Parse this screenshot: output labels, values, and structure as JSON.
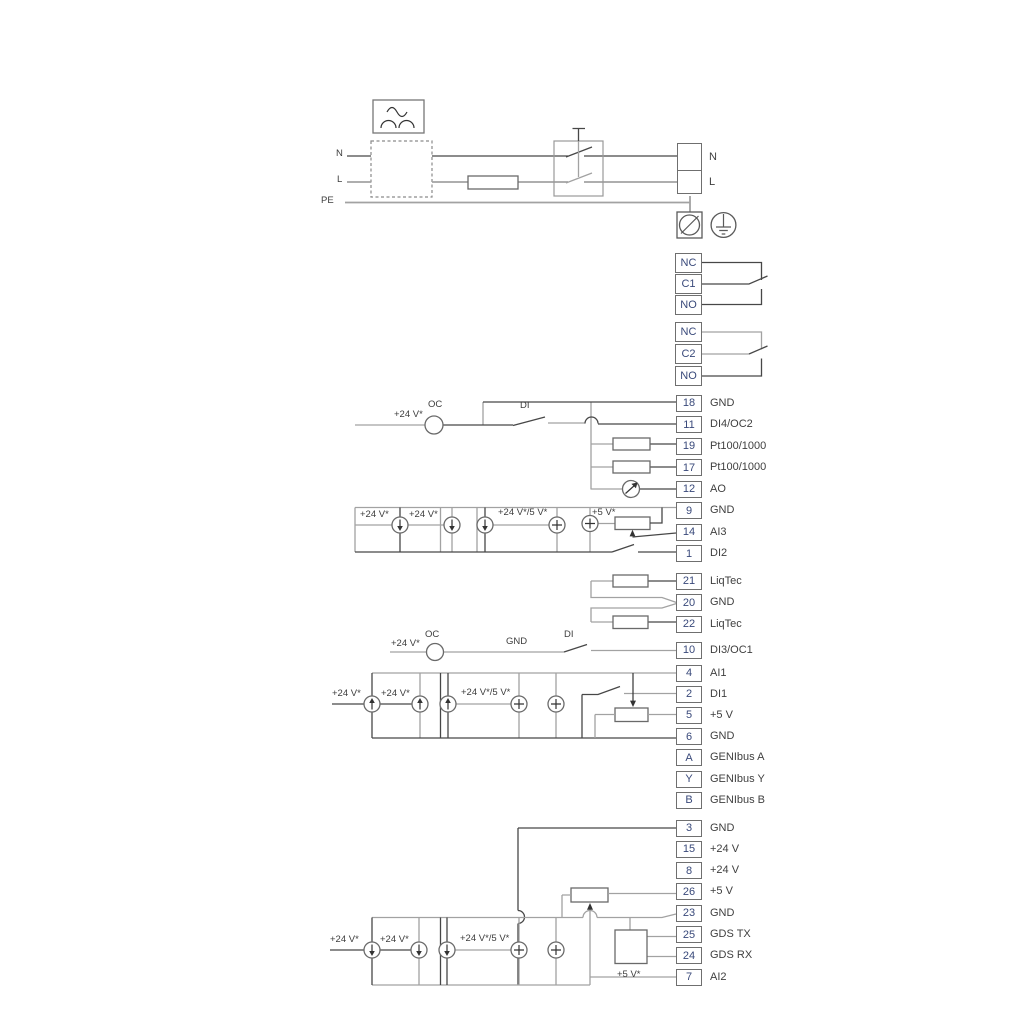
{
  "title": "Pump wiring diagram",
  "colors": {
    "wire_dark": "#474747",
    "wire_gray": "#a2a2a2",
    "number_color": "#39497a",
    "label_color": "#3f3f3f",
    "annotation_color": "#3d3d3d",
    "background": "#ffffff"
  },
  "terminal_blocks": [
    {
      "name": "mains-terminal-block",
      "x": 677,
      "w": 25,
      "label_x": 709,
      "rows": [
        {
          "no": "",
          "label": "N",
          "top": 143,
          "h": 28.5
        },
        {
          "no": "",
          "label": "L",
          "top": 170,
          "h": 24
        }
      ]
    },
    {
      "name": "relay1-terminal-block",
      "x": 675,
      "w": 27,
      "rows": [
        {
          "no": "NC",
          "top": 253,
          "h": 20
        },
        {
          "no": "C1",
          "top": 274,
          "h": 20
        },
        {
          "no": "NO",
          "top": 295,
          "h": 20
        }
      ]
    },
    {
      "name": "relay2-terminal-block",
      "x": 675,
      "w": 27,
      "rows": [
        {
          "no": "NC",
          "top": 322,
          "h": 20
        },
        {
          "no": "C2",
          "top": 344,
          "h": 20
        },
        {
          "no": "NO",
          "top": 366,
          "h": 20
        }
      ]
    },
    {
      "name": "io-terminal-block-1",
      "x": 676,
      "w": 26,
      "label_x": 710,
      "rows": [
        {
          "no": "18",
          "label": "GND",
          "top": 394.5
        },
        {
          "no": "11",
          "label": "DI4/OC2",
          "top": 416
        },
        {
          "no": "19",
          "label": "Pt100/1000",
          "top": 437.5
        },
        {
          "no": "17",
          "label": "Pt100/1000",
          "top": 459
        },
        {
          "no": "12",
          "label": "AO",
          "top": 480.5
        },
        {
          "no": "9",
          "label": "GND",
          "top": 502
        },
        {
          "no": "14",
          "label": "AI3",
          "top": 523.5
        },
        {
          "no": "1",
          "label": "DI2",
          "top": 545
        }
      ]
    },
    {
      "name": "liqtec-terminal-block",
      "x": 676,
      "w": 26,
      "label_x": 710,
      "rows": [
        {
          "no": "21",
          "label": "LiqTec",
          "top": 572.5
        },
        {
          "no": "20",
          "label": "GND",
          "top": 594
        },
        {
          "no": "22",
          "label": "LiqTec",
          "top": 615.5
        }
      ]
    },
    {
      "name": "di3-terminal-block",
      "x": 676,
      "w": 26,
      "label_x": 710,
      "rows": [
        {
          "no": "10",
          "label": "DI3/OC1",
          "top": 641.5
        }
      ]
    },
    {
      "name": "io-terminal-block-2",
      "x": 676,
      "w": 26,
      "label_x": 710,
      "rows": [
        {
          "no": "4",
          "label": "AI1",
          "top": 664.5
        },
        {
          "no": "2",
          "label": "DI1",
          "top": 685.7
        },
        {
          "no": "5",
          "label": "+5 V",
          "top": 706.9
        },
        {
          "no": "6",
          "label": "GND",
          "top": 728.1
        },
        {
          "no": "A",
          "label": "GENIbus A",
          "top": 749.3
        },
        {
          "no": "Y",
          "label": "GENIbus Y",
          "top": 770.5
        },
        {
          "no": "B",
          "label": "GENIbus B",
          "top": 791.7
        }
      ]
    },
    {
      "name": "io-terminal-block-3",
      "x": 676,
      "w": 26,
      "label_x": 710,
      "rows": [
        {
          "no": "3",
          "label": "GND",
          "top": 819.5
        },
        {
          "no": "15",
          "label": "+24 V",
          "top": 840.8
        },
        {
          "no": "8",
          "label": "+24 V",
          "top": 862.1
        },
        {
          "no": "26",
          "label": "+5 V",
          "top": 883.4
        },
        {
          "no": "23",
          "label": "GND",
          "top": 904.7
        },
        {
          "no": "25",
          "label": "GDS TX",
          "top": 926
        },
        {
          "no": "24",
          "label": "GDS RX",
          "top": 947.3
        },
        {
          "no": "7",
          "label": "AI2",
          "top": 968.6
        }
      ]
    }
  ],
  "annotations": [
    {
      "name": "label-n-left",
      "text": "N",
      "x": 336,
      "y": 149
    },
    {
      "name": "label-l-left",
      "text": "L",
      "x": 337,
      "y": 175
    },
    {
      "name": "label-pe",
      "text": "PE",
      "x": 321,
      "y": 196
    },
    {
      "name": "di4-supply-label",
      "text": "+24 V*",
      "x": 394,
      "y": 410
    },
    {
      "name": "di4-oc-label",
      "text": "OC",
      "x": 428,
      "y": 400
    },
    {
      "name": "di4-di-label",
      "text": "DI",
      "x": 520,
      "y": 401
    },
    {
      "name": "ai3-supply-label-1",
      "text": "+24 V*",
      "x": 360,
      "y": 510
    },
    {
      "name": "ai3-supply-label-2",
      "text": "+24 V*",
      "x": 409,
      "y": 510
    },
    {
      "name": "ai3-supply-label-3",
      "text": "+24 V*/5 V*",
      "x": 498,
      "y": 508
    },
    {
      "name": "ai3-supply-label-4",
      "text": "+5 V*",
      "x": 592,
      "y": 508
    },
    {
      "name": "di3-supply-label",
      "text": "+24 V*",
      "x": 391,
      "y": 639
    },
    {
      "name": "di3-oc-label",
      "text": "OC",
      "x": 425,
      "y": 630
    },
    {
      "name": "di3-gnd-label",
      "text": "GND",
      "x": 506,
      "y": 637
    },
    {
      "name": "di3-di-label",
      "text": "DI",
      "x": 564,
      "y": 630
    },
    {
      "name": "ai1-supply-label-1",
      "text": "+24 V*",
      "x": 332,
      "y": 689
    },
    {
      "name": "ai1-supply-label-2",
      "text": "+24 V*",
      "x": 381,
      "y": 689
    },
    {
      "name": "ai1-supply-label-3",
      "text": "+24 V*/5 V*",
      "x": 461,
      "y": 688
    },
    {
      "name": "ai2-supply-label-1",
      "text": "+24 V*",
      "x": 330,
      "y": 935
    },
    {
      "name": "ai2-supply-label-2",
      "text": "+24 V*",
      "x": 380,
      "y": 935
    },
    {
      "name": "ai2-supply-label-3",
      "text": "+24 V*/5 V*",
      "x": 460,
      "y": 934
    },
    {
      "name": "ai2-supply-label-4",
      "text": "+5 V*",
      "x": 617,
      "y": 970
    }
  ]
}
